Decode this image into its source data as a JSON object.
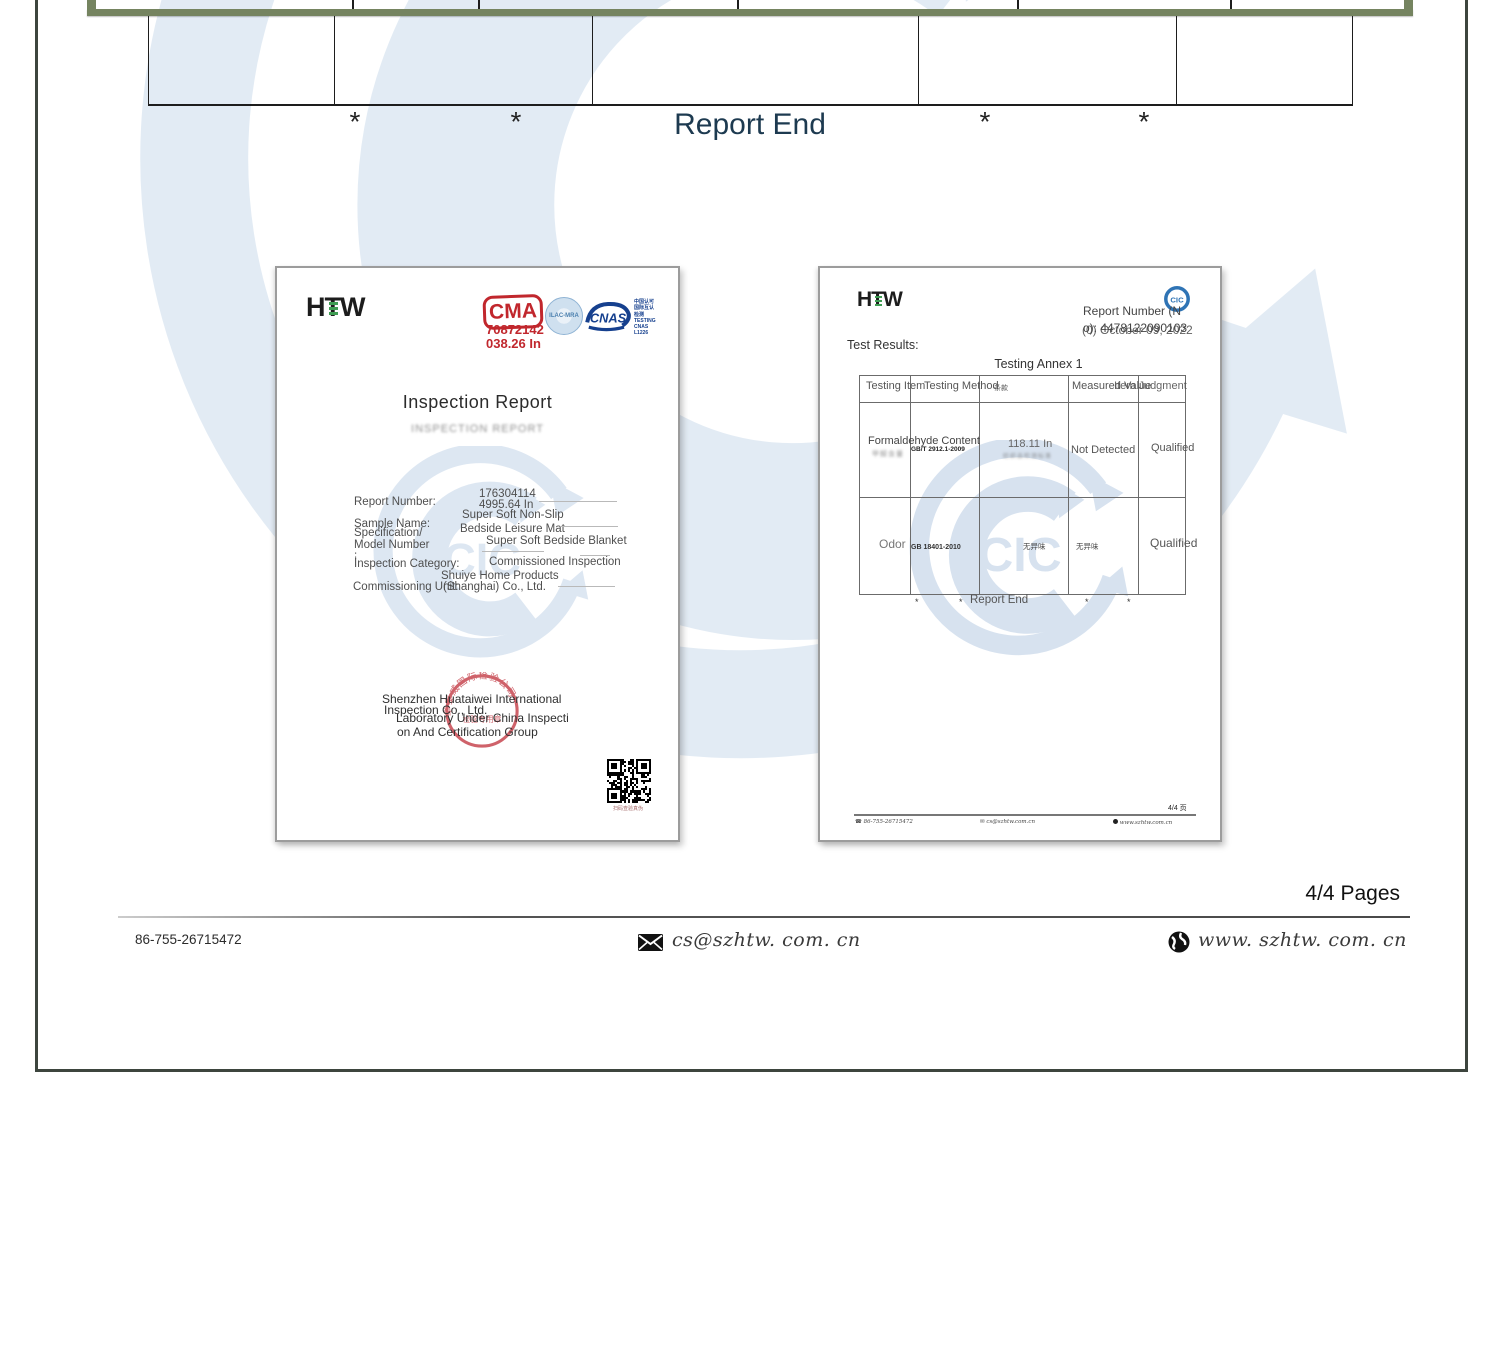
{
  "colors": {
    "green_border": "#758460",
    "report_end_text": "#1d3a50",
    "cma_red": "#c1272d",
    "cnas_blue": "#16408e",
    "watermark_blue": "#c6d8ea",
    "stamp_red": "#c5404a"
  },
  "page": {
    "report_end": "Report End",
    "asterisk": "*",
    "pages_label": "4/4 Pages",
    "footer": {
      "phone": "86-755-26715472",
      "email": "cs@szhtw. com. cn",
      "website": "www. szhtw. com. cn"
    }
  },
  "watermark_text": "CIC",
  "left_doc": {
    "logo_h": "H",
    "logo_t": "T",
    "logo_w": "W",
    "cma": {
      "label": "CMA",
      "line1": "70872142",
      "line2": "038.26 In"
    },
    "ilac": "ILAC-MRA",
    "cnas": {
      "label": "CNAS",
      "side_cn": "中国认可 国际互认 检测",
      "side_en": "TESTING CNAS L1226"
    },
    "title": "Inspection Report",
    "subtitle": "INSPECTION REPORT",
    "fields": [
      {
        "label": "Report Number:",
        "value1": "176304114",
        "value2": "4995.64 In"
      },
      {
        "label": "Sample Name:",
        "value1": "Super Soft Non-Slip",
        "value2": "Bedside Leisure Mat"
      },
      {
        "label": "Specification/",
        "label2": "Model Number",
        "label3": ":",
        "value1": "Super Soft Bedside Blanket"
      },
      {
        "label": "İnspection Category:",
        "value1": "Commissioned Inspection"
      },
      {
        "label": "Commissioning Unit:",
        "value1": "Shuiye Home Products",
        "value2": "(Shanghai) Co., Ltd."
      }
    ],
    "company_line1": "Shenzhen Huataiwei International",
    "company_line2": "Inspection Co., Ltd.",
    "company_line3": "Laboratory Under China Inspecti",
    "company_line4": "on And Certification Group",
    "stamp_arc": "华泰威国际检验公司",
    "stamp_center": "检验专用章",
    "qr_caption": "扫码查验真伪"
  },
  "right_doc": {
    "logo_h": "H",
    "logo_t": "T",
    "logo_w": "W",
    "cic": "CIC",
    "report_number_line1": "Report Number (N",
    "report_number_line2": "o): 4478122090103",
    "date_overlay": "(0) October 09, 2022",
    "test_results": "Test Results:",
    "annex_title": "Testing Annex 1",
    "table": {
      "header_item": "Testing Item",
      "header_method": "Testing Method",
      "header_method_cn": "条款",
      "header_measured": "Measured Value",
      "header_judgment": "Item Judgment",
      "rows": [
        {
          "item": "Formaldehyde Content",
          "item_cn": "甲醛含量",
          "method": "GB/T 2912.1-2009",
          "measured": "118.11 In",
          "measured_cn": "纺织品检测标准",
          "value": "Not Detected",
          "judgment": "Qualified"
        },
        {
          "item": "Odor",
          "item_cn": "",
          "method": "GB 18401-2010",
          "measured": "无异味",
          "measured_cn": "",
          "value": "无异味",
          "judgment": "Qualified"
        }
      ]
    },
    "report_end": "Report End",
    "dot": "*",
    "page_label": "4/4 页",
    "footer": {
      "phone_icon": "☎",
      "mail_icon": "✉",
      "phone": "86-755-26715472",
      "email": "cs@szhtw.com.cn",
      "website": "www.szhtw.com.cn"
    }
  }
}
